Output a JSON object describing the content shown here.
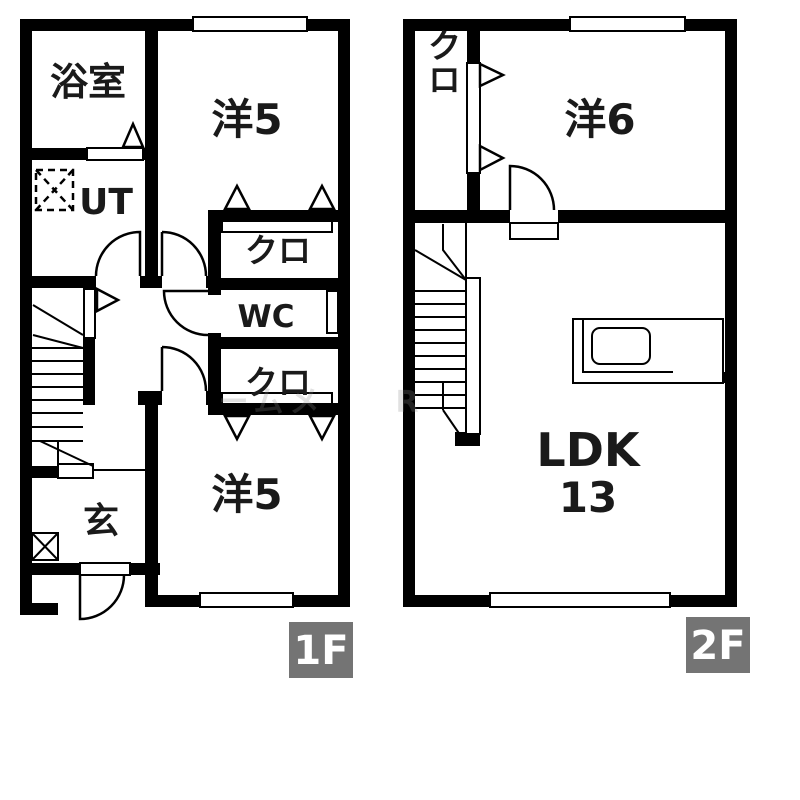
{
  "title": "2-story apartment floor plan",
  "f1": {
    "tag": "1F",
    "bath": "浴室",
    "ut": "UT",
    "room_top": "洋5",
    "closet_top": "クロ",
    "wc": "WC",
    "closet_bottom": "クロ",
    "room_bottom": "洋5",
    "entrance": "玄"
  },
  "f2": {
    "tag": "2F",
    "closet": "クロ",
    "room": "洋6",
    "ldk": "LDK",
    "ldk_size": "13"
  },
  "watermark": {
    "a": "ームメ",
    "b": "R"
  },
  "colors": {
    "wall": "#000000",
    "background": "#ffffff",
    "floor_tag_bg": "#747474",
    "floor_tag_text": "#ffffff"
  }
}
